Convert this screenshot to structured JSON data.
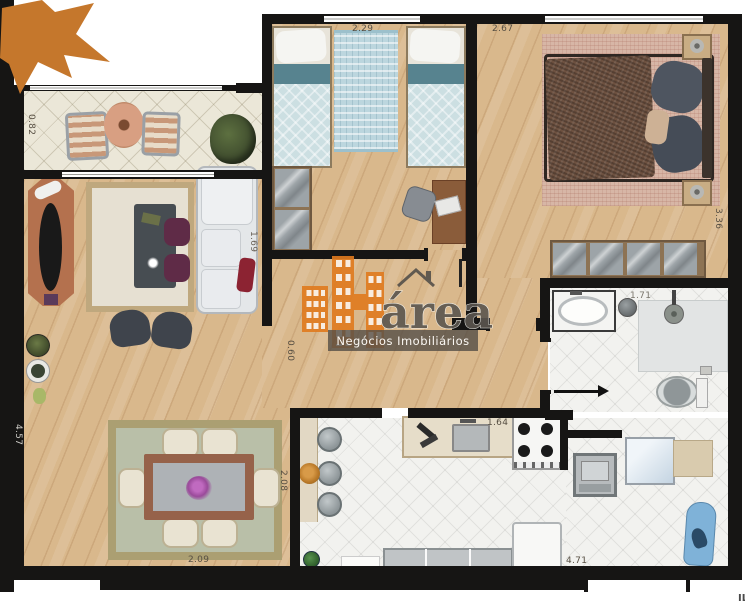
{
  "watermark": {
    "brand": "Hárea",
    "brand_text": "área",
    "tagline": "Negócios Imobiliários",
    "accent_color": "#e07a1e"
  },
  "footer": {
    "notice_label": "ILUSTRAÇÃO ARTÍSTICA:",
    "notice_text": " Imagem meramente ilustrativa."
  },
  "dimensions": {
    "balcony_depth": "0.82",
    "bedroom2_width": "2.29",
    "master_width": "2.67",
    "sofa_length": "1.69",
    "master_depth": "3.36",
    "bathroom_width": "1.71",
    "hall_width": "0.60",
    "kitchen_counter_width": "1.64",
    "dining_rug_width": "2.09",
    "dining_rug_depth": "2.08",
    "living_depth": "4.57",
    "service_width": "4.71"
  },
  "colors": {
    "wall": "#161514",
    "wood_floor": "#d9b88c",
    "tile_cream": "#ebe7d8",
    "tile_white": "#f2f2ef",
    "accent_orange": "#c5772c"
  }
}
